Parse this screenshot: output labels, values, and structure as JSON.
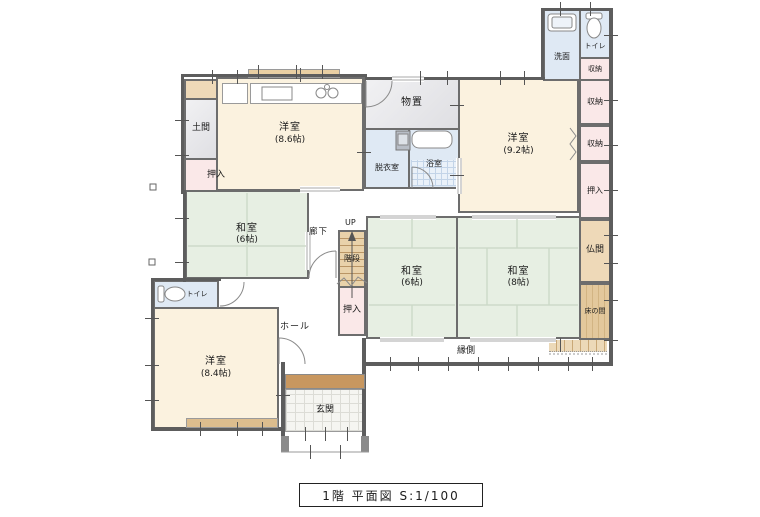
{
  "title": {
    "text": "1階 平面図 S:1/100"
  },
  "rooms": {
    "kitchen": {
      "label": "洋室",
      "size": "(8.6帖)"
    },
    "youshitsu92": {
      "label": "洋室",
      "size": "(9.2帖)"
    },
    "youshitsu84": {
      "label": "洋室",
      "size": "(8.4帖)"
    },
    "washitsu6a": {
      "label": "和室",
      "size": "(6帖)"
    },
    "washitsu6b": {
      "label": "和室",
      "size": "(6帖)"
    },
    "washitsu8": {
      "label": "和室",
      "size": "(8帖)"
    },
    "doma": {
      "label": "土間"
    },
    "oshiire_nw": {
      "label": "押入"
    },
    "monooki": {
      "label": "物置"
    },
    "datsui": {
      "label": "脱衣室"
    },
    "yokushitsu": {
      "label": "浴室"
    },
    "senmen": {
      "label": "洗面"
    },
    "toire_ne": {
      "label": "トイレ"
    },
    "shuunou1": {
      "label": "収納"
    },
    "shuunou2": {
      "label": "収納"
    },
    "shuunou3": {
      "label": "収納"
    },
    "oshiire_e": {
      "label": "押入"
    },
    "butsuma": {
      "label": "仏間"
    },
    "tokonoma": {
      "label": "床の間"
    },
    "rouka": {
      "label": "廊下"
    },
    "kaidan": {
      "label": "階段",
      "up": "UP"
    },
    "oshiire_kaidan": {
      "label": "押入"
    },
    "hall": {
      "label": "ホール"
    },
    "toire_w": {
      "label": "トイレ"
    },
    "genkan": {
      "label": "玄関"
    },
    "engawa": {
      "label": "縁側"
    }
  },
  "colors": {
    "wall": "#5d5d5d",
    "western_room": "#fbf2df",
    "tatami_room": "#e7efe3",
    "closet": "#fae8e8",
    "wet_area": "#dfe9f4",
    "storage_gray": "#e9e9ec",
    "altar_tan": "#eed9b8",
    "entry_step_brown": "#c8975f",
    "stairs_tan": "#e9d2aa"
  }
}
